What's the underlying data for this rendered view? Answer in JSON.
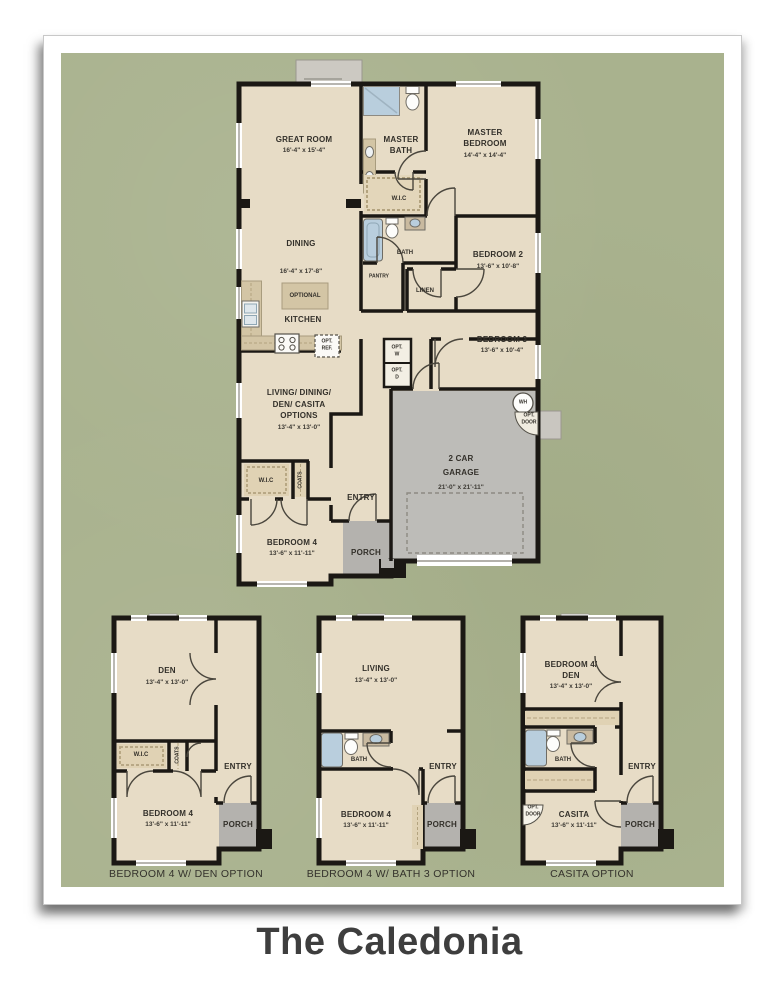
{
  "title": "The Caledonia",
  "colors": {
    "mat_green": "#a9b28e",
    "room_beige": "#e7dcc6",
    "accent_tan": "#d3c5a5",
    "wall_black": "#1b1814",
    "garage_gray": "#bdbcb8",
    "porch_gray": "#b4b2ae",
    "fixture_blue": "#b9cedd",
    "title_gray": "#3e3e3e"
  },
  "main_plan": {
    "great_room": {
      "name": "GREAT ROOM",
      "dims": "16'-4\" x 15'-4\""
    },
    "master_bath": {
      "line1": "MASTER",
      "line2": "BATH"
    },
    "master_bedroom": {
      "line1": "MASTER",
      "line2": "BEDROOM",
      "dims": "14'-4\" x 14'-4\""
    },
    "wic_master": "W.I.C",
    "dining": {
      "name": "DINING",
      "dims": "16'-4\" x 17'-8\""
    },
    "bath": "BATH",
    "pantry": "PANTRY",
    "linen": "LINEN",
    "bedroom2": {
      "name": "BEDROOM 2",
      "dims": "13'-6\" x 10'-8\""
    },
    "optional_island": "OPTIONAL",
    "kitchen": "KITCHEN",
    "opt_ref": {
      "line1": "OPT.",
      "line2": "REF."
    },
    "bedroom3": {
      "name": "BEDROOM 3",
      "dims": "13'-6\" x 10'-4\""
    },
    "opt_w": {
      "line1": "OPT.",
      "line2": "W"
    },
    "opt_d": {
      "line1": "OPT.",
      "line2": "D"
    },
    "living_options": {
      "line1": "LIVING/ DINING/",
      "line2": "DEN/ CASITA",
      "line3": "OPTIONS",
      "dims": "13'-4\" x 13'-0\""
    },
    "wh": "WH",
    "opt_door": {
      "line1": "OPT.",
      "line2": "DOOR"
    },
    "garage": {
      "line1": "2 CAR",
      "line2": "GARAGE",
      "dims": "21'-0\" x 21'-11\""
    },
    "wic_bed4": "W.I.C",
    "coats": "COATS",
    "entry": "ENTRY",
    "bedroom4": {
      "name": "BEDROOM 4",
      "dims": "13'-6\" x 11'-11\""
    },
    "porch": "PORCH"
  },
  "option_plans": [
    {
      "caption": "BEDROOM 4 W/ DEN OPTION",
      "room_top": {
        "line1": "DEN",
        "dims": "13'-4\" x 13'-0\""
      },
      "wic": "W.I.C",
      "coats": "COATS",
      "entry": "ENTRY",
      "bedroom": {
        "name": "BEDROOM 4",
        "dims": "13'-6\" x 11'-11\""
      },
      "porch": "PORCH"
    },
    {
      "caption": "BEDROOM 4 W/ BATH 3 OPTION",
      "room_top": {
        "line1": "LIVING",
        "dims": "13'-4\" x 13'-0\""
      },
      "bath": "BATH",
      "entry": "ENTRY",
      "bedroom": {
        "name": "BEDROOM 4",
        "dims": "13'-6\" x 11'-11\""
      },
      "porch": "PORCH"
    },
    {
      "caption": "CASITA OPTION",
      "room_top": {
        "line1": "BEDROOM 4/",
        "line2": "DEN",
        "dims": "13'-4\" x 13'-0\""
      },
      "bath": "BATH",
      "entry": "ENTRY",
      "opt_door": {
        "line1": "OPT.",
        "line2": "DOOR"
      },
      "bedroom": {
        "name": "CASITA",
        "dims": "13'-6\" x 11'-11\""
      },
      "porch": "PORCH"
    }
  ]
}
